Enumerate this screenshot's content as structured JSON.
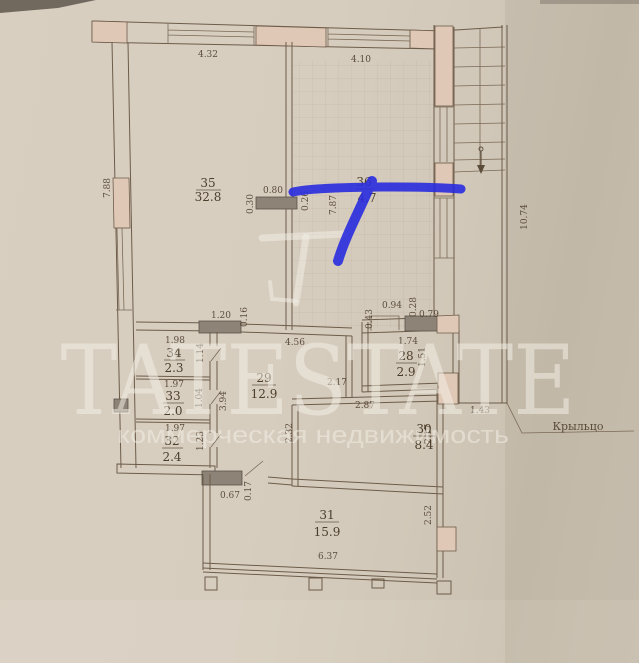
{
  "watermark": {
    "brand": "TATESTATE",
    "tagline": "коммерческая недвижимость",
    "monogram_icon": "tl-monogram"
  },
  "annotation": {
    "marker_color": "#2a2cdf",
    "type": "hand-drawn highlighter strokes"
  },
  "colors": {
    "paper": "#d7cdbf",
    "plan_line": "#6d5c49",
    "wall_pink": "#e0c8b6",
    "pier_gray": "#8d8477"
  },
  "plan": {
    "labels": {
      "porch": "Крыльцо"
    },
    "rooms": {
      "r35": {
        "number": "35",
        "area": "32.8"
      },
      "r36": {
        "number": "36",
        "area": "4.7"
      },
      "r34": {
        "number": "34",
        "area": "2.3"
      },
      "r33": {
        "number": "33",
        "area": "2.0"
      },
      "r32": {
        "number": "32",
        "area": "2.4"
      },
      "r29": {
        "number": "29",
        "area": "12.9"
      },
      "r28": {
        "number": "28",
        "area": "2.9"
      },
      "r30": {
        "number": "30",
        "area": "8.4"
      },
      "r31": {
        "number": "31",
        "area": "15.9"
      }
    },
    "dims": {
      "top_left": "4.32",
      "top_right": "4.10",
      "left_height": "7.88",
      "right_height": "10.74",
      "door35_w": "0.80",
      "door35_t": "0.30",
      "door35_side": "0.26",
      "hall_vert": "7.87",
      "mid_pier_w": "1.20",
      "mid_pier_t": "0.16",
      "r34_w": "1.98",
      "r34_h": "1.14",
      "r33_w": "1.97",
      "r33_h": "1.04",
      "r32_w": "1.97",
      "r32_h": "1.23",
      "r29_w": "4.56",
      "r29_h": "3.94",
      "p094": "0.94",
      "p043": "0.43",
      "p028": "0.28",
      "p079": "0.79",
      "r28_w": "1.74",
      "r28_h": "1.51",
      "hall217": "2.17",
      "r30_w": "2.87",
      "r30_h": "2.17",
      "c232": "2.32",
      "porch_w": "1.43",
      "d067": "0.67",
      "d017": "0.17",
      "r31_w": "6.37",
      "r31_h": "2.52"
    }
  }
}
